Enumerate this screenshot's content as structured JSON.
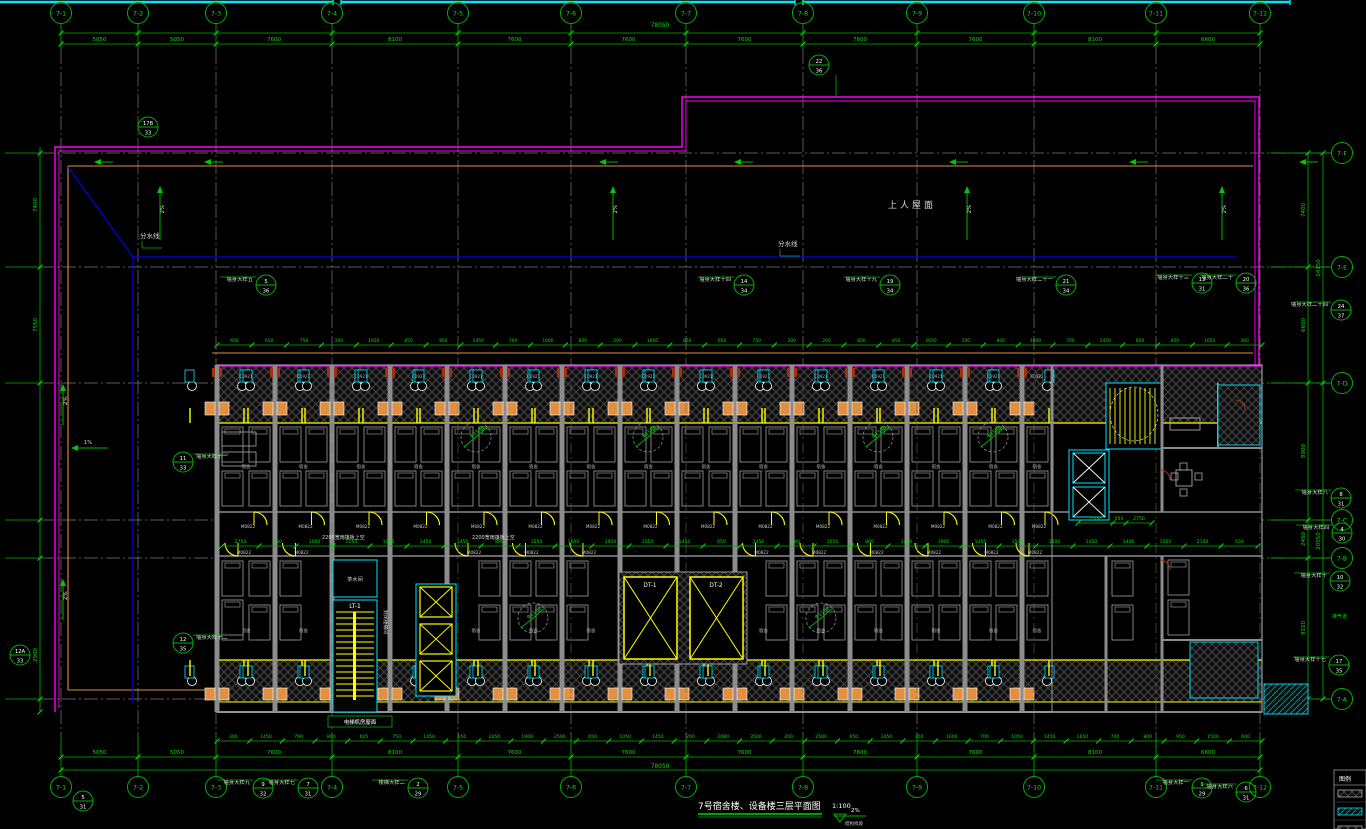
{
  "meta": {
    "title": "7号宿舍楼、设备楼三层平面图",
    "scale": "1:100",
    "slope_percent": "2%",
    "slope_note": "结构找坡"
  },
  "colors": {
    "bg": "#000000",
    "line_green": "#00b400",
    "text_green": "#00e000",
    "magenta": "#ff00ff",
    "cyan": "#00e5ff",
    "yellow": "#ffff00",
    "orange": "#e09040",
    "wall_gray": "#8c8c8c",
    "grid_gray": "#787878",
    "blue": "#0000ee",
    "white": "#ffffff",
    "dark_red": "#a03010"
  },
  "grid": {
    "cols": [
      {
        "label": "7-1",
        "x": 61
      },
      {
        "label": "7-2",
        "x": 138
      },
      {
        "label": "7-3",
        "x": 216
      },
      {
        "label": "7-4",
        "x": 332
      },
      {
        "label": "7-5",
        "x": 458
      },
      {
        "label": "7-6",
        "x": 571
      },
      {
        "label": "7-7",
        "x": 686
      },
      {
        "label": "7-8",
        "x": 803
      },
      {
        "label": "7-9",
        "x": 917
      },
      {
        "label": "7-10",
        "x": 1034
      },
      {
        "label": "7-11",
        "x": 1156
      },
      {
        "label": "7-12",
        "x": 1260
      }
    ],
    "rows": [
      {
        "label": "7-F",
        "y": 153
      },
      {
        "label": "7-E",
        "y": 267
      },
      {
        "label": "7-D",
        "y": 383
      },
      {
        "label": "7-C",
        "y": 520
      },
      {
        "label": "7-B",
        "y": 558
      },
      {
        "label": "7-A",
        "y": 699
      }
    ]
  },
  "dims": {
    "overall": "78050",
    "cols": [
      "5050",
      "5050",
      "7600",
      "8100",
      "7600",
      "7600",
      "7600",
      "7600",
      "7600",
      "8100",
      "6600"
    ],
    "rows_inner": [
      "7400",
      "6600",
      "8900",
      "2450",
      "9150"
    ],
    "rows_outer": [
      "14150",
      "20550"
    ],
    "left": [
      "7400",
      "7550",
      "2900"
    ],
    "band_top": [
      "650",
      "650",
      "750",
      "200",
      "1650",
      "850",
      "850",
      "1450",
      "700",
      "1000",
      "800",
      "200",
      "1650",
      "650",
      "650",
      "750",
      "300",
      "200",
      "850",
      "850",
      "1650",
      "200",
      "800",
      "1000",
      "700",
      "1450",
      "850",
      "850",
      "1650",
      "300"
    ],
    "corridor": [
      "2750",
      "250",
      "1000",
      "1250",
      "1000",
      "1450",
      "1450",
      "800",
      "1550",
      "1600",
      "1950",
      "1050",
      "1450",
      "650",
      "1450",
      "700",
      "1050",
      "800",
      "1450",
      "1900",
      "1450",
      "1500",
      "1300",
      "1050",
      "1400",
      "1550",
      "2100",
      "550"
    ],
    "bottom_small": [
      "300",
      "1450",
      "790",
      "800",
      "605",
      "750",
      "1450",
      "650",
      "2050",
      "1900",
      "2500",
      "650",
      "1050",
      "1450",
      "200",
      "2080",
      "3500",
      "200",
      "2500",
      "650",
      "1450",
      "700",
      "1600",
      "700",
      "1050",
      "1450",
      "1650",
      "700",
      "800",
      "950",
      "1500",
      "600"
    ],
    "right_core": [
      "2100",
      "550",
      "2750"
    ]
  },
  "roof": {
    "label_roof": "上人屋面",
    "label_divide": "分水线",
    "slope_main": "2%",
    "slope_small": "1%",
    "divide_positions": [
      {
        "x": 140,
        "y": 238
      },
      {
        "x": 778,
        "y": 246
      }
    ]
  },
  "building": {
    "room_label": "宿舍",
    "door_tag": "M0822",
    "window_tag": "C0921",
    "turn_circle": "Φ1500",
    "corridor_note_text": "2200宽雨篷板上空",
    "corridor_notes": [
      {
        "x": 322,
        "y": 539
      },
      {
        "x": 472,
        "y": 539
      }
    ],
    "machine_note": "电梯机房屋面"
  },
  "core": {
    "stair1": "LT-1",
    "stair1_room": "封闭楼梯间",
    "tea_room": "茶水间",
    "lift1": "DT-1",
    "lift2": "DT-2",
    "vent": "排气道"
  },
  "callouts": [
    {
      "x": 148,
      "y": 127,
      "t": "17B",
      "b": "33"
    },
    {
      "x": 819,
      "y": 65,
      "t": "22",
      "b": "36"
    },
    {
      "x": 266,
      "y": 285,
      "t": "5",
      "b": "36",
      "label": "墙身大样五"
    },
    {
      "x": 744,
      "y": 285,
      "t": "14",
      "b": "34",
      "label": "墙身大样十四"
    },
    {
      "x": 890,
      "y": 285,
      "t": "19",
      "b": "34",
      "label": "墙身大样十九"
    },
    {
      "x": 1066,
      "y": 285,
      "t": "21",
      "b": "34",
      "label": "墙身大样二十一"
    },
    {
      "x": 1202,
      "y": 283,
      "t": "13",
      "b": "31",
      "label": "墙身大样十三"
    },
    {
      "x": 1246,
      "y": 283,
      "t": "20",
      "b": "36",
      "label": "墙身大样二十"
    },
    {
      "x": 1341,
      "y": 310,
      "t": "24",
      "b": "37",
      "label": "墙身大样二十四"
    },
    {
      "x": 1341,
      "y": 498,
      "t": "8",
      "b": "31",
      "label": "墙身大样八"
    },
    {
      "x": 1342,
      "y": 533,
      "t": "4",
      "b": "30",
      "label": "墙身大样四"
    },
    {
      "x": 1340,
      "y": 581,
      "t": "10",
      "b": "32",
      "label": "墙身大样十"
    },
    {
      "x": 1339,
      "y": 665,
      "t": "17",
      "b": "35",
      "label": "墙身大样十七"
    },
    {
      "x": 183,
      "y": 462,
      "t": "11",
      "b": "33",
      "label": "墙身大样十一",
      "side": "right"
    },
    {
      "x": 183,
      "y": 643,
      "t": "12",
      "b": "35",
      "label": "墙身大样十二",
      "side": "right"
    },
    {
      "x": 20,
      "y": 655,
      "t": "12A",
      "b": "33"
    },
    {
      "x": 83,
      "y": 801,
      "t": "5",
      "b": "31"
    },
    {
      "x": 263,
      "y": 788,
      "t": "9",
      "b": "32",
      "label": "墙身大样九"
    },
    {
      "x": 308,
      "y": 788,
      "t": "7",
      "b": "31",
      "label": "墙身大样七"
    },
    {
      "x": 418,
      "y": 788,
      "t": "2",
      "b": "29",
      "label": "楼梯大样二"
    },
    {
      "x": 1202,
      "y": 788,
      "t": "1",
      "b": "29",
      "label": "墙身大样一"
    },
    {
      "x": 1246,
      "y": 792,
      "t": "6",
      "b": "31",
      "label": "墙身大样六"
    }
  ],
  "legend": {
    "title": "图例",
    "items": [
      {
        "type": "hatch-gray"
      },
      {
        "type": "hatch-cyan"
      },
      {
        "type": "hatch-gray"
      }
    ]
  }
}
